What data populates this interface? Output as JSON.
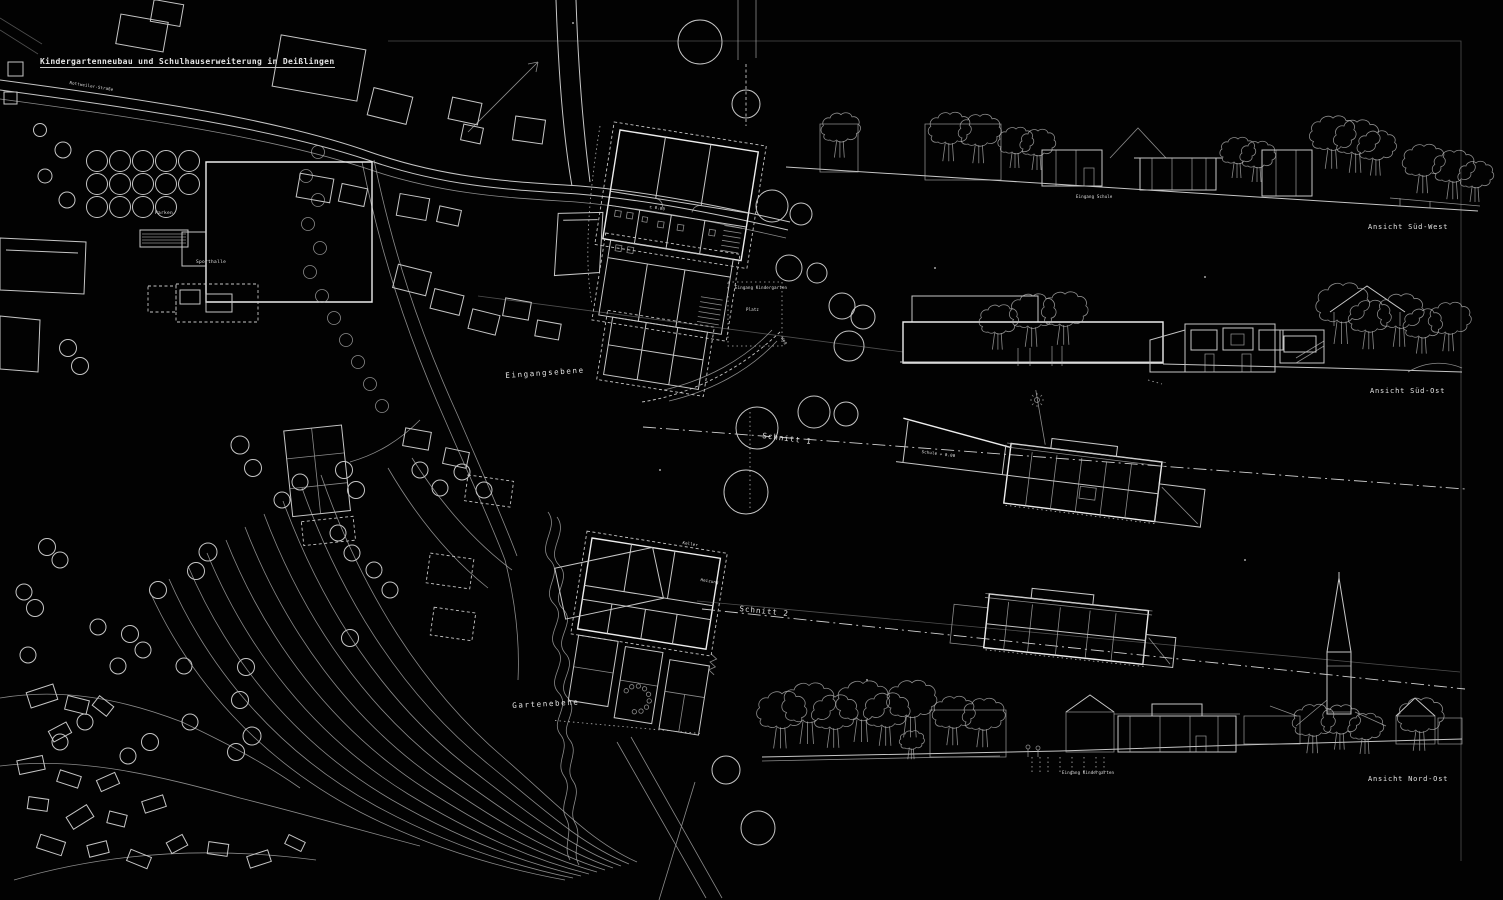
{
  "title": "Kindergartenneubau und Schulhauserweiterung in Deißlingen",
  "site_plan": {
    "street_label": "Rottweiler-Straße",
    "parking_label": "Parken",
    "sports_hall_label": "Sporthalle",
    "entrance_level_label": "Eingangsebene",
    "garden_level_label": "Gartenebene",
    "kindergarten_entrance_label": "Eingang Kindergarten",
    "square_label": "Platz",
    "path_label": "Weg",
    "level_mark": "± 0.00"
  },
  "floor_plan_lower": {
    "cellar_label": "Keller",
    "heating_label": "Heizung"
  },
  "sections": {
    "section1_label": "Schnitt 1",
    "section2_label": "Schnitt 2",
    "section1_level_note": "Schule + 0.00"
  },
  "elevations": {
    "south_west_label": "Ansicht Süd-West",
    "south_east_label": "Ansicht Süd-Ost",
    "north_east_label": "Ansicht Nord-Ost",
    "school_entrance_label": "Eingang Schule",
    "kindergarten_entrance_label": "Eingang Kindergarten"
  },
  "colors": {
    "background": "#000000",
    "line": "#c9c9c9",
    "text": "#e6e6e6"
  }
}
